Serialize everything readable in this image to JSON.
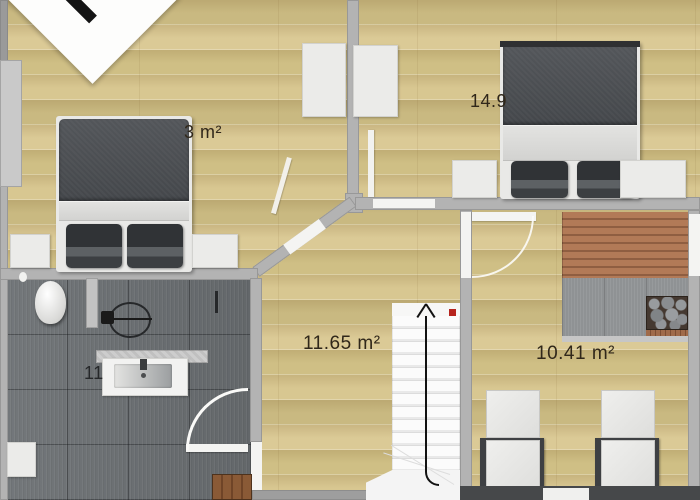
{
  "title": "Upper floor plan",
  "labels": {
    "bedroom_left": "3 m²",
    "bedroom_right": "14.9",
    "hallway": "11.65 m²",
    "sauna_room": "10.41 m²",
    "bathroom": "11"
  },
  "stairs": {
    "direction_label": "up"
  },
  "colors": {
    "wood_floor": "#d5c48e",
    "wall": "#b3b3b3",
    "bathroom_tile": "#6d7174",
    "bed_duvet": "#474a4e",
    "sauna_bench": "#ad7353",
    "stair_marker_red": "#b6241e",
    "label_text": "#30271a"
  },
  "rooms": [
    {
      "name": "bedroom-left",
      "area_label": "3 m²",
      "note": "label partially hidden by bed"
    },
    {
      "name": "bedroom-right",
      "area_label": "14.9",
      "note": "label partially hidden by bed"
    },
    {
      "name": "hallway",
      "area_label": "11.65 m²"
    },
    {
      "name": "sauna-room",
      "area_label": "10.41 m²"
    },
    {
      "name": "bathroom",
      "area_label": "11",
      "note": "label partially hidden by vanity"
    }
  ]
}
